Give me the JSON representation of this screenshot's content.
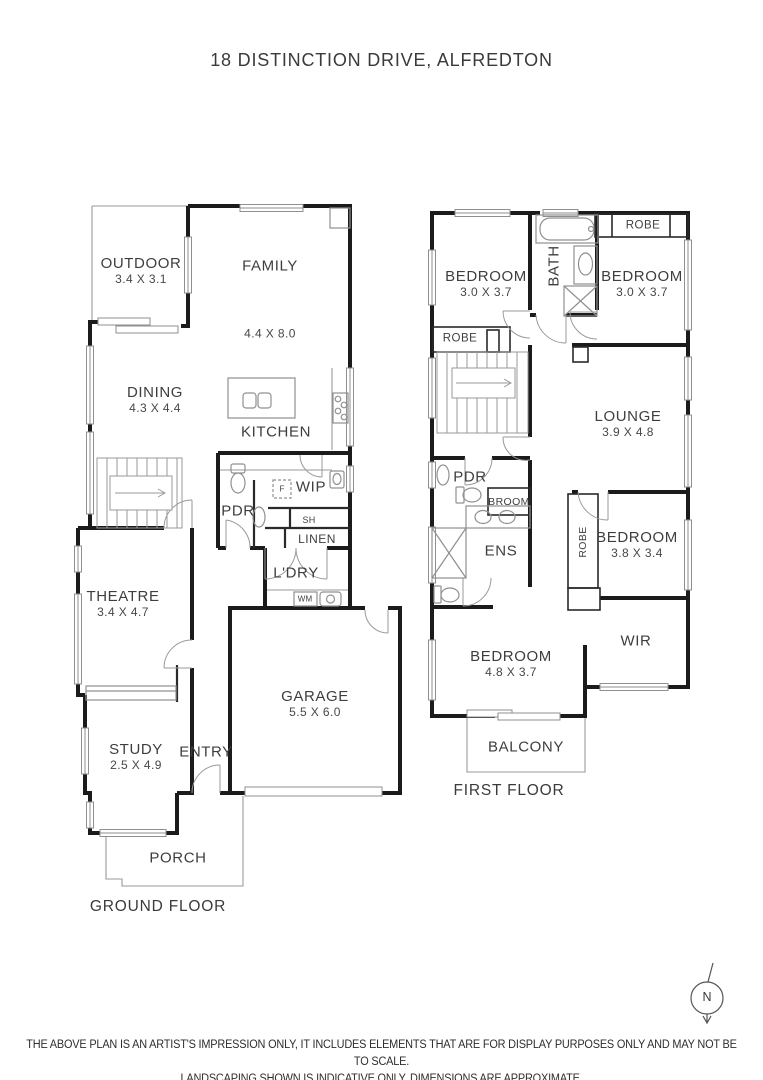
{
  "title": "18 DISTINCTION DRIVE, ALFREDTON",
  "ground": {
    "floor_label": "GROUND FLOOR",
    "outdoor": {
      "name": "OUTDOOR",
      "dim": "3.4 X 3.1"
    },
    "family": {
      "name": "FAMILY",
      "dim": "4.4 X 8.0"
    },
    "dining": {
      "name": "DINING",
      "dim": "4.3 X 4.4"
    },
    "kitchen": {
      "name": "KITCHEN"
    },
    "wip": {
      "name": "WIP"
    },
    "fridge": {
      "name": "F"
    },
    "pdr": {
      "name": "PDR"
    },
    "shelf": {
      "name": "SH"
    },
    "linen": {
      "name": "LINEN"
    },
    "laundry": {
      "name": "L'DRY"
    },
    "washing_machine": {
      "name": "WM"
    },
    "theatre": {
      "name": "THEATRE",
      "dim": "3.4 X 4.7"
    },
    "study": {
      "name": "STUDY",
      "dim": "2.5 X 4.9"
    },
    "entry": {
      "name": "ENTRY"
    },
    "garage": {
      "name": "GARAGE",
      "dim": "5.5 X 6.0"
    },
    "porch": {
      "name": "PORCH"
    }
  },
  "first": {
    "floor_label": "FIRST FLOOR",
    "bedroom1": {
      "name": "BEDROOM",
      "dim": "3.0 X 3.7"
    },
    "bath": {
      "name": "BATH"
    },
    "robe_top": {
      "name": "ROBE"
    },
    "bedroom2": {
      "name": "BEDROOM",
      "dim": "3.0 X 3.7"
    },
    "robe_left": {
      "name": "ROBE"
    },
    "lounge": {
      "name": "LOUNGE",
      "dim": "3.9 X 4.8"
    },
    "pdr": {
      "name": "PDR"
    },
    "broom": {
      "name": "BROOM"
    },
    "ens": {
      "name": "ENS"
    },
    "robe_bed3": {
      "name": "ROBE"
    },
    "bedroom3": {
      "name": "BEDROOM",
      "dim": "3.8 X 3.4"
    },
    "wir": {
      "name": "WIR"
    },
    "bedroom4": {
      "name": "BEDROOM",
      "dim": "4.8 X 3.7"
    },
    "balcony": {
      "name": "BALCONY"
    }
  },
  "compass": {
    "label": "N"
  },
  "disclaimer": {
    "line1": "THE ABOVE PLAN IS AN ARTIST'S IMPRESSION ONLY, IT INCLUDES ELEMENTS THAT ARE FOR DISPLAY PURPOSES ONLY AND MAY NOT BE TO SCALE.",
    "line2": "LANDSCAPING SHOWN IS INDICATIVE ONLY. DIMENSIONS ARE APPROXIMATE."
  },
  "colors": {
    "wall": "#1b1b1b",
    "thin_line": "#9a9a9a",
    "text": "#3e3e3e",
    "background": "#ffffff"
  }
}
